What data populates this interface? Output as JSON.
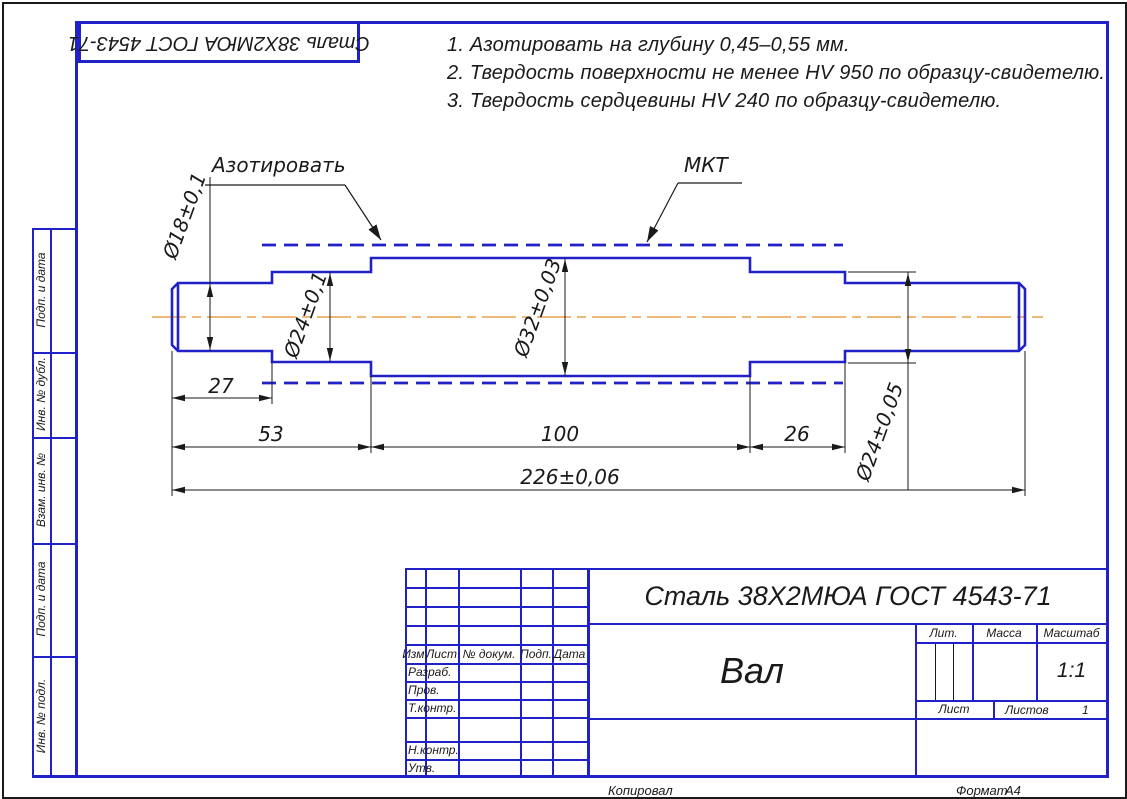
{
  "stamp_top": {
    "material": "Сталь 38Х2МЮА ГОСТ 4543-71"
  },
  "notes": [
    "1. Азотировать на глубину 0,45–0,55 мм.",
    "2. Твердость поверхности не менее HV 950 по образцу-свидетелю.",
    "3. Твердость сердцевины HV 240 по образцу-свидетелю."
  ],
  "drawing": {
    "labels": {
      "nitride": "Азотировать",
      "mkt": "МКТ"
    },
    "dimensions": {
      "d18": "Ø18±0,1",
      "d24a": "Ø24±0,1",
      "d32": "Ø32±0,03",
      "d24b": "Ø24±0,05",
      "len27": "27",
      "len53": "53",
      "len100": "100",
      "len26": "26",
      "total": "226±0,06"
    },
    "colors": {
      "outline_blue": "#2121c8",
      "centerline_orange": "#e8a04a",
      "dimension_black": "#1a1a1a"
    }
  },
  "side_strip": {
    "items": [
      {
        "label": "Подп. и дата"
      },
      {
        "label": "Инв. № дубл."
      },
      {
        "label": "Взам. инв. №"
      },
      {
        "label": "Подп. и дата"
      },
      {
        "label": "Инв. № подл."
      }
    ]
  },
  "title_block": {
    "material": "Сталь 38Х2МЮА ГОСТ 4543-71",
    "part_name": "Вал",
    "col_headers": {
      "izm": "Изм.",
      "list": "Лист",
      "doc": "№ докум.",
      "podp": "Подп.",
      "data": "Дата"
    },
    "rows": {
      "razrab": "Разраб.",
      "prov": "Пров.",
      "tkontr": "Т.контр.",
      "nkontr": "Н.контр.",
      "utv": "Утв."
    },
    "lit_label": "Лит.",
    "massa_label": "Масса",
    "masshtab_label": "Масштаб",
    "scale_value": "1:1",
    "sheet_label": "Лист",
    "sheets_label": "Листов",
    "sheets_value": "1"
  },
  "footer": {
    "copied": "Копировал",
    "format_label": "Формат",
    "format_value": "А4"
  }
}
